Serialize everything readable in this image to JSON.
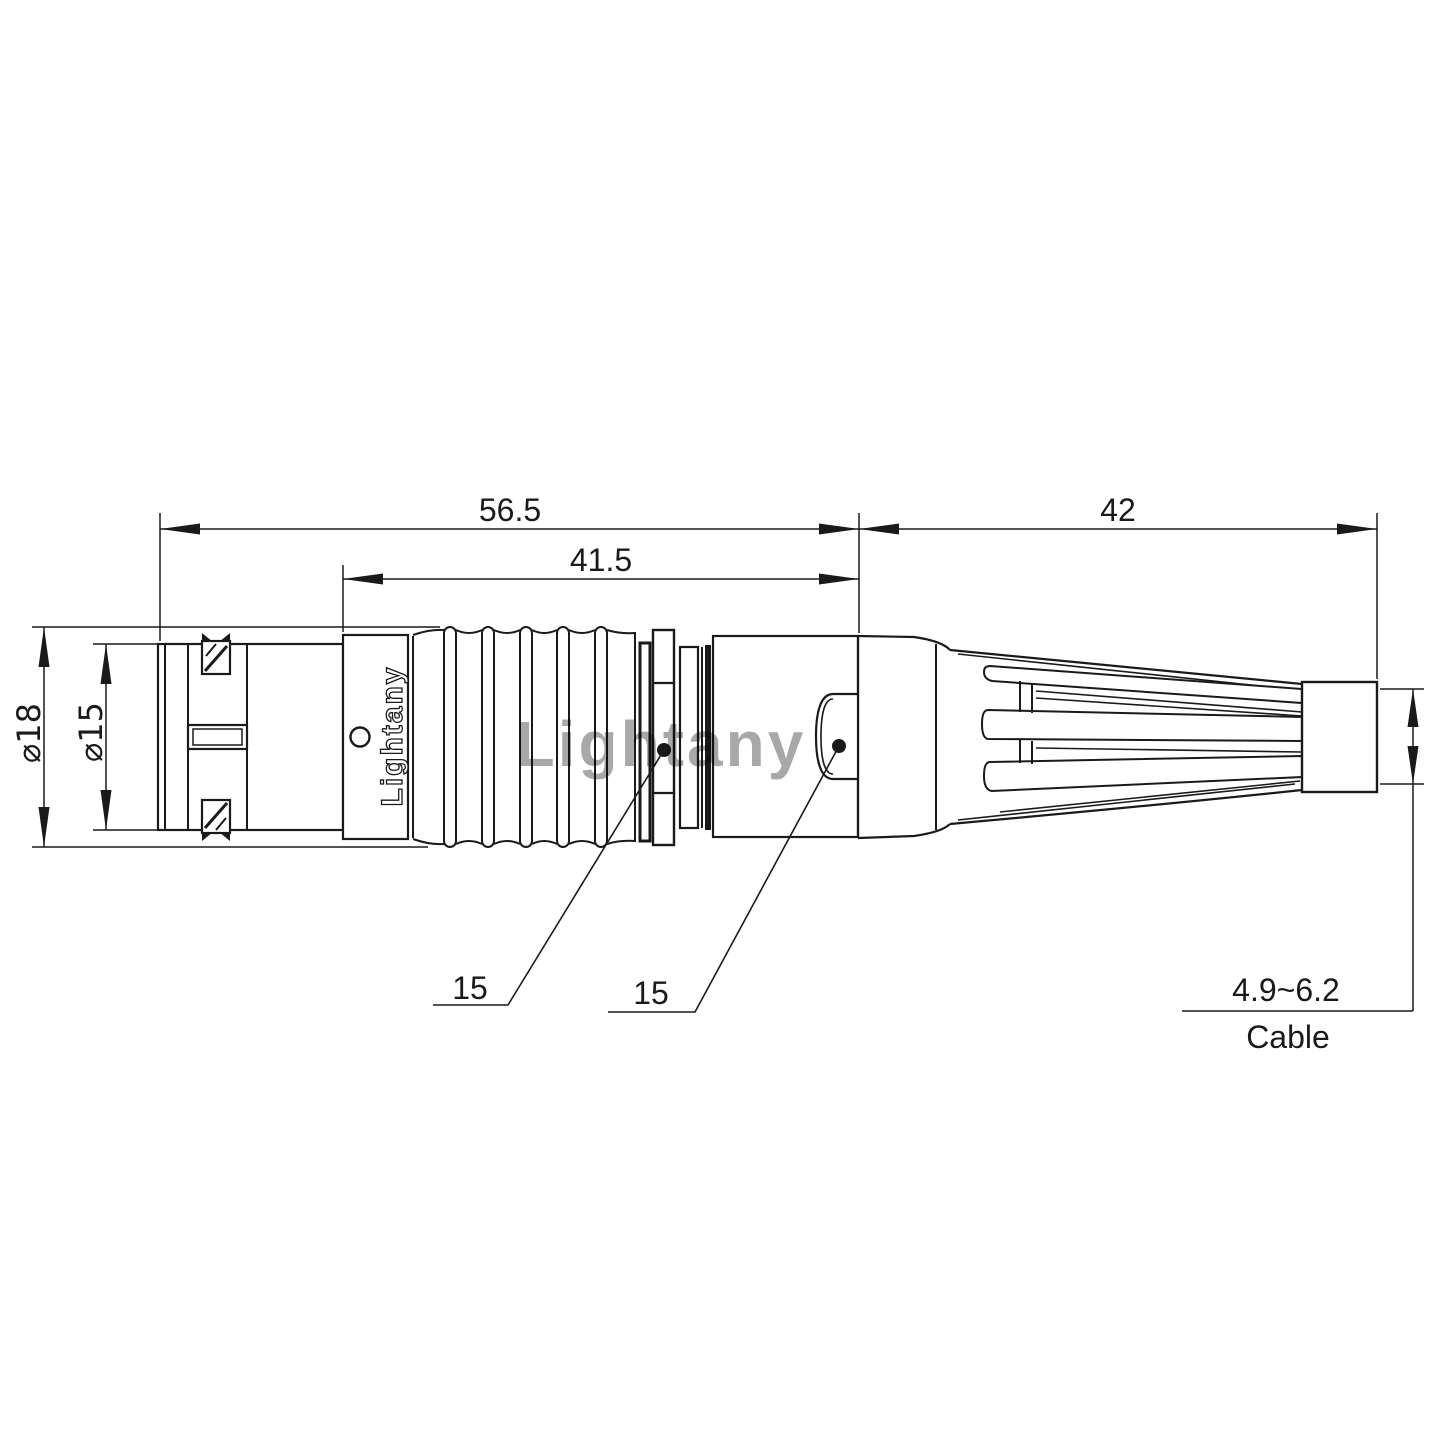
{
  "watermark": {
    "text": "Lightany",
    "color": "#dd6b6b"
  },
  "connector": {
    "logo_text": "Lightany"
  },
  "dimensions": {
    "overall_length": {
      "value": "56.5"
    },
    "grip_length": {
      "value": "41.5"
    },
    "boot_length": {
      "value": "42"
    },
    "outer_diameter": {
      "value": "⌀18"
    },
    "front_diameter": {
      "value": "⌀15"
    },
    "callout_left": {
      "value": "15"
    },
    "callout_right": {
      "value": "15"
    },
    "cable": {
      "range": "4.9~6.2",
      "label": "Cable"
    }
  },
  "colors": {
    "line": "#1a1a1a",
    "background": "#ffffff"
  }
}
